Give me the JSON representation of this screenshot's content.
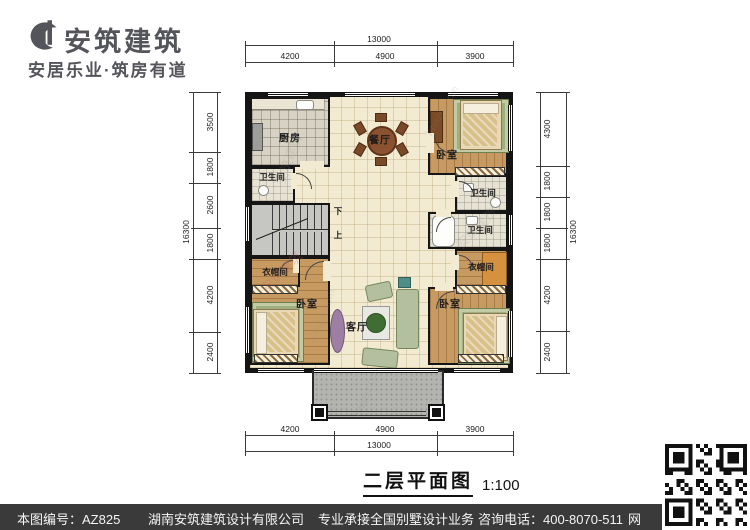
{
  "logo": {
    "company": "安筑建筑",
    "slogan": "安居乐业·筑房有道"
  },
  "plan": {
    "title": "二层平面图",
    "scale": "1:100",
    "rooms": {
      "kitchen": "厨房",
      "dining": "餐厅",
      "bedroom_top_right": "卧室",
      "bedroom_bottom_left": "卧室",
      "bedroom_bottom_right": "卧室",
      "living": "客厅",
      "bath_left": "卫生间",
      "bath_right_upper": "卫生间",
      "bath_right_lower": "卫生间",
      "cloak_left": "衣帽间",
      "cloak_right": "衣帽间",
      "stair_down": "下",
      "stair_up": "上"
    },
    "dims": {
      "top": {
        "overall": "13000",
        "segments": [
          "4200",
          "4900",
          "3900"
        ]
      },
      "bottom": {
        "overall": "13000",
        "segments": [
          "4200",
          "4900",
          "3900"
        ]
      },
      "left": {
        "overall": "16300",
        "segments": [
          "3500",
          "1800",
          "2600",
          "1800",
          "4200",
          "2400"
        ]
      },
      "right": {
        "overall": "16300",
        "segments": [
          "4300",
          "1800",
          "1800",
          "1800",
          "4200",
          "2400"
        ]
      }
    }
  },
  "watermark": {
    "name": "安筑建筑",
    "site": "hnazjz.com"
  },
  "footer": {
    "drawing_no": "本图编号：AZ825",
    "company": "湖南安筑建筑设计有限公司",
    "service": "专业承接全国别墅设计业务",
    "phone": "咨询电话：400-8070-511",
    "web": "网"
  },
  "colors": {
    "wall": "#141414",
    "wood": "#c79a62",
    "floor": "#f3ead2",
    "footer_bg": "#3a3a3a"
  }
}
